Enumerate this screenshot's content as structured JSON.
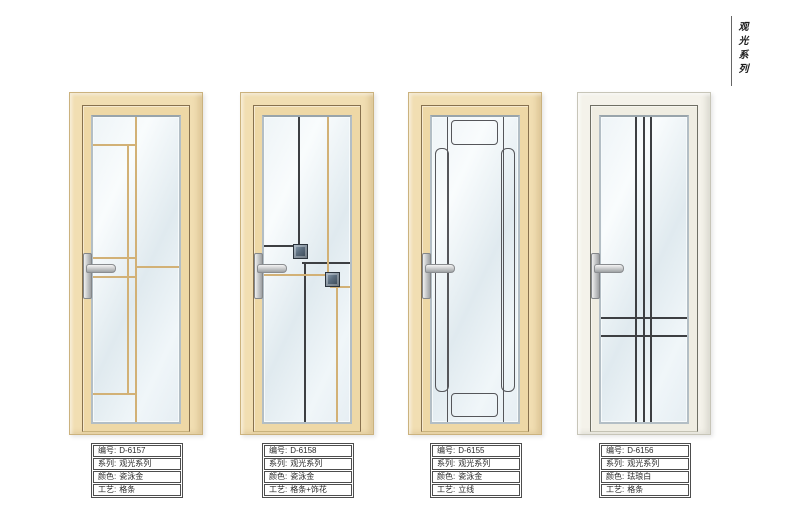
{
  "page": {
    "series_label": "观光系列"
  },
  "palette": {
    "frame_cream": "#f1deb2",
    "leaf_cream": "#eed8a6",
    "frame_white": "#f4f2ea",
    "accent_line": "#87714e",
    "glass_tint": "#e6eef3",
    "grid_gold": "#d2b176",
    "grid_black": "#3d3f42",
    "grid_gray": "#55565a",
    "handle_silver": "#c9ccce"
  },
  "labels": {
    "code": "编号:",
    "series": "系列:",
    "color": "颜色:",
    "craft": "工艺:"
  },
  "doors": [
    {
      "code": "D-6157",
      "series": "观光系列",
      "color": "瓷泳金",
      "craft": "格条"
    },
    {
      "code": "D-6158",
      "series": "观光系列",
      "color": "瓷泳金",
      "craft": "格条+饰花"
    },
    {
      "code": "D-6155",
      "series": "观光系列",
      "color": "瓷泳金",
      "craft": "立线"
    },
    {
      "code": "D-6156",
      "series": "观光系列",
      "color": "珐琅白",
      "craft": "格条"
    }
  ]
}
